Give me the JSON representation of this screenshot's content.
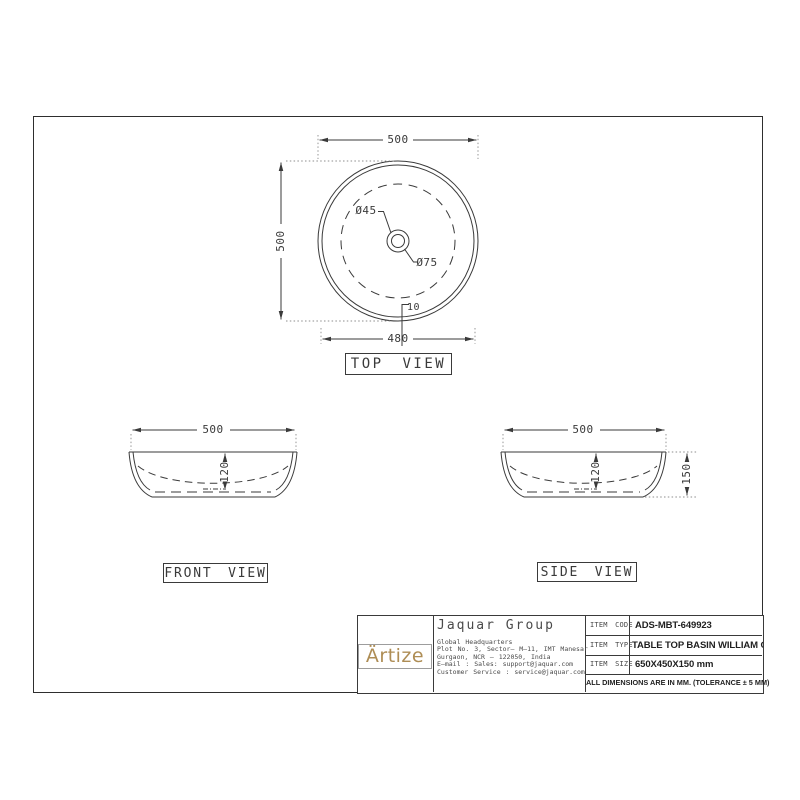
{
  "colors": {
    "line": "#3a3a3a",
    "extension": "#8c8c8c",
    "gold": "#ae8d55"
  },
  "top_view": {
    "label": "TOP VIEW",
    "dim_top": "500",
    "dim_left": "500",
    "dim_bottom": "480",
    "dim_rim": "10",
    "dim_drain_inner": "Ø45",
    "dim_drain_outer": "Ø75"
  },
  "front_view": {
    "label": "FRONT VIEW",
    "dim_width": "500",
    "dim_depth": "120"
  },
  "side_view": {
    "label": "SIDE VIEW",
    "dim_width": "500",
    "dim_depth": "120",
    "dim_height": "150"
  },
  "title_block": {
    "logo": "Ärtize",
    "company": "Jaquar Group",
    "address": [
      "Global Headquarters",
      "Plot No. 3, Sector– M–11, IMT Manesar",
      "Gurgaon, NCR – 122050, India",
      "E–mail : Sales: support@jaquar.com",
      "Customer Service : service@jaquar.com"
    ],
    "rows": [
      {
        "label": "ITEM CODE",
        "value": "ADS-MBT-649923"
      },
      {
        "label": "ITEM TYPE",
        "value": "TABLE TOP BASIN WILLIAM GREY"
      },
      {
        "label": "ITEM SIZE",
        "value": "650X450X150 mm"
      }
    ],
    "note": "ALL DIMENSIONS ARE IN MM. (TOLERANCE ± 5 MM)"
  }
}
